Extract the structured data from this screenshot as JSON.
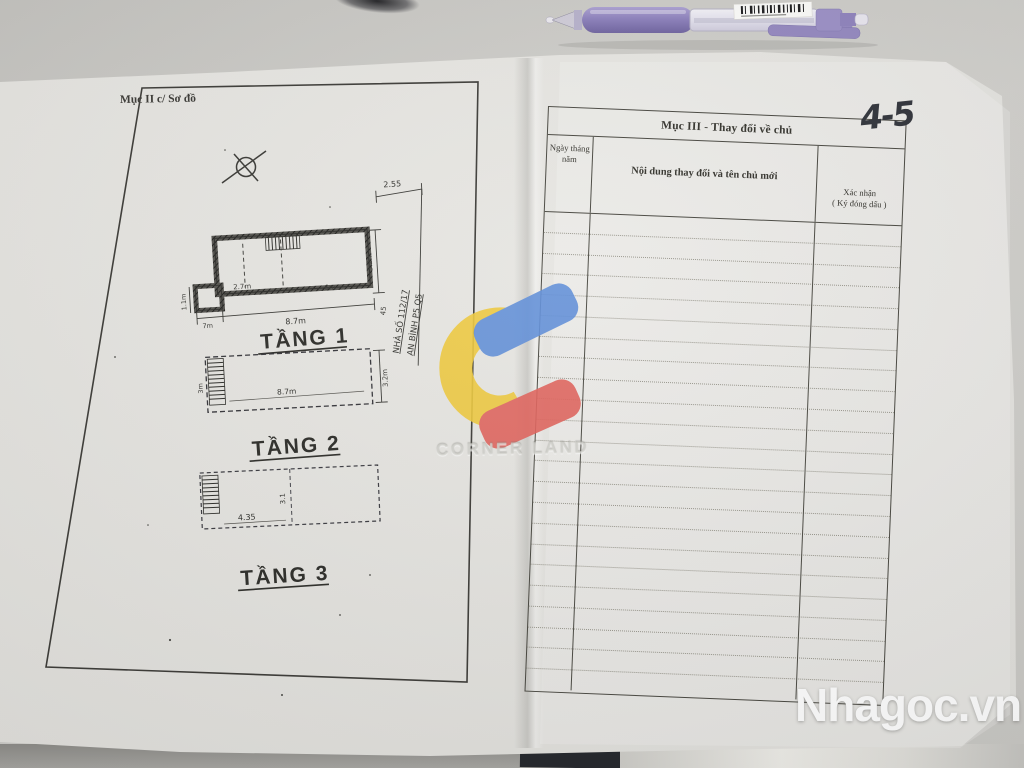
{
  "left_page": {
    "section_label": "Mục II c/ Sơ đồ",
    "address_line1": "NHÀ SỐ 112/17",
    "address_line2": "AN BÌNH P5 Q5",
    "floors": [
      {
        "title": "TẦNG 1",
        "dims": {
          "room_left": "2.7m",
          "room_right": "6m",
          "notch": "7m",
          "width": "8.7m",
          "left": "1.1m",
          "right": "3.2m",
          "offset": "45",
          "top": "2.55"
        }
      },
      {
        "title": "TẦNG 2",
        "dims": {
          "width": "8.7m",
          "right": "3.2m",
          "left": "3m"
        }
      },
      {
        "title": "TẦNG 3",
        "dims": {
          "width": "4.35",
          "mid": "3.1"
        }
      }
    ]
  },
  "right_page": {
    "table_title": "Mục III - Thay đổi về chủ",
    "col1_line1": "Ngày tháng",
    "col1_line2": "năm",
    "col2": "Nội dung thay đổi và tên chủ mới",
    "col3_line1": "Xác nhận",
    "col3_line2": "( Ký đóng dấu )",
    "empty_row_count": 23,
    "handwritten_page_note": "4-5"
  },
  "overlays": {
    "watermark_text": "CORNER LAND",
    "site_brand": "Nhagoc.vn"
  },
  "colors": {
    "logo_blue": "#5f8ed8",
    "logo_yellow": "#eec93d",
    "logo_red": "#e0625b",
    "pen_purple": "#9488c0",
    "paper": "#e7e6e2",
    "desk": "#cdccc8",
    "table_line": "#47463f"
  }
}
